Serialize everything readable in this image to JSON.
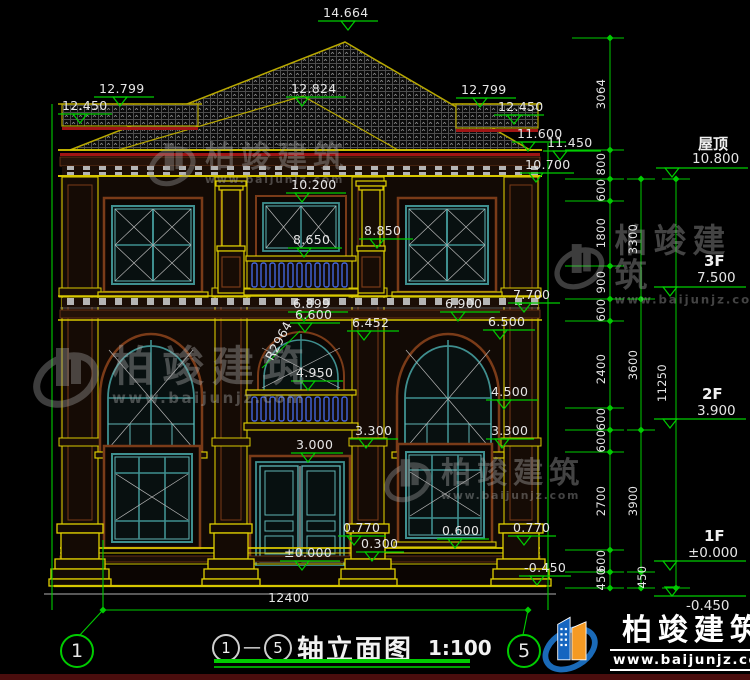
{
  "colors": {
    "dim_green": "#00cc00",
    "trim_yellow": "#d8c800",
    "wall_brown": "#7a3b18",
    "window_teal": "#3f8f8f",
    "baluster_blue": "#4466dd",
    "accent_red": "#a01414",
    "logo_blue": "#1565c0",
    "logo_orange": "#f59a23"
  },
  "watermark": {
    "name": "柏竣建筑",
    "url": "www.baijunjz.com"
  },
  "brand": {
    "name": "柏竣建筑",
    "url": "www.baijunjz.com"
  },
  "title": {
    "from": "1",
    "to": "5",
    "text": "轴立面图",
    "scale": "1:100"
  },
  "axes": {
    "left": "1",
    "right": "5"
  },
  "dims": {
    "ridge": "14.664",
    "l_12799": "12.799",
    "l_12450": "12.450",
    "m_12824": "12.824",
    "r_12799": "12.799",
    "r_12450": "12.450",
    "r_11600": "11.600",
    "r_11450": "11.450",
    "r_10700": "10.700",
    "c_10200": "10.200",
    "c_8850": "8.850",
    "c_8650": "8.650",
    "r_7700": "7.700",
    "c_6899": "6.899",
    "c_6600": "6.600",
    "c_6452": "6.452",
    "r_6900": "6.900",
    "r_6500": "6.500",
    "radius": "R2964",
    "c_4950": "4.950",
    "r_4500": "4.500",
    "c_3300": "3.300",
    "r_3300": "3.300",
    "c_3000": "3.000",
    "b_0770_l": "0.770",
    "b_0300": "0.300",
    "b_0600": "0.600",
    "b_0770_r": "0.770",
    "b_pm0000": "±0.000",
    "b_m0450": "-0.450",
    "span": "12400"
  },
  "levels": [
    {
      "label": "屋顶",
      "value": "10.800"
    },
    {
      "label": "3F",
      "value": "7.500"
    },
    {
      "label": "2F",
      "value": "3.900"
    },
    {
      "label": "1F",
      "value": "±0.000"
    },
    {
      "label": "",
      "value": "-0.450"
    }
  ],
  "chains": {
    "inner": [
      "3064",
      "800",
      "600",
      "1800",
      "900",
      "600",
      "2400",
      "600",
      "600",
      "2700",
      "600",
      "450"
    ],
    "outer": [
      "3300",
      "3600",
      "3900",
      "450"
    ],
    "total": "11250"
  }
}
